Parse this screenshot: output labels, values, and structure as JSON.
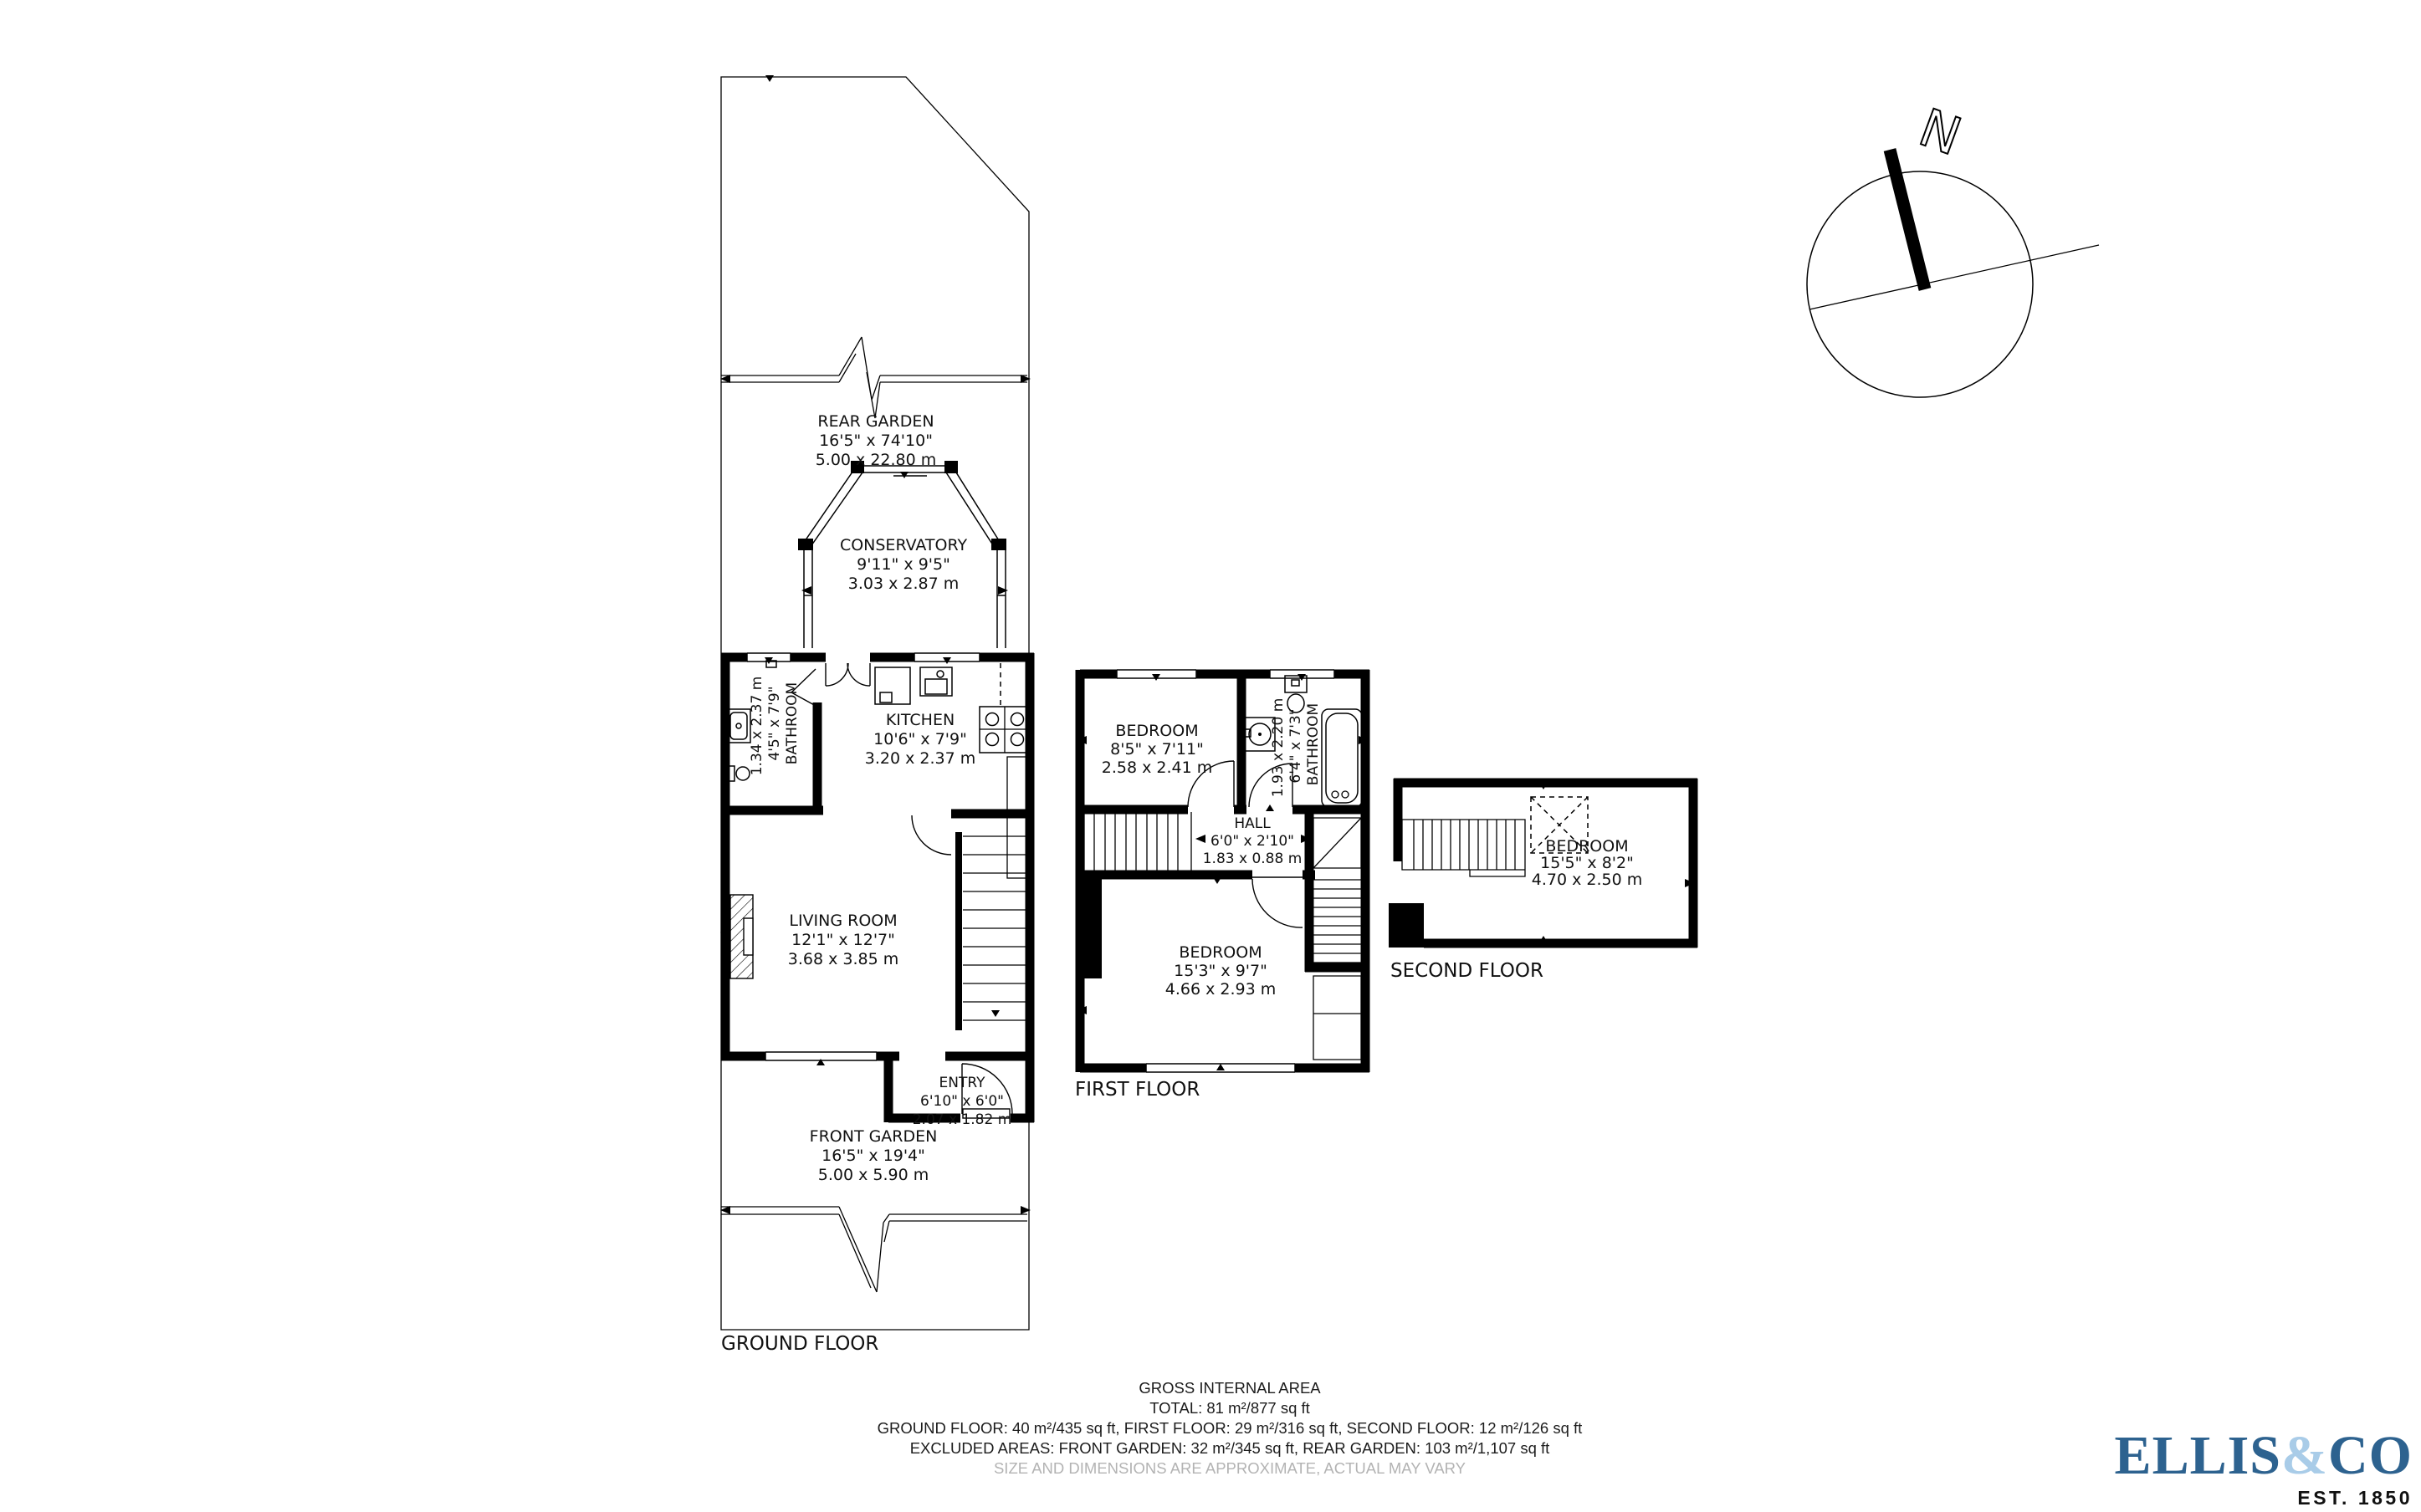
{
  "compass": {
    "north": "N"
  },
  "gf": {
    "label": "GROUND FLOOR",
    "rear_garden": {
      "name": "REAR GARDEN",
      "imp": "16'5\" x 74'10\"",
      "met": "5.00 x 22.80 m"
    },
    "conservatory": {
      "name": "CONSERVATORY",
      "imp": "9'11\" x 9'5\"",
      "met": "3.03 x 2.87 m"
    },
    "kitchen": {
      "name": "KITCHEN",
      "imp": "10'6\" x 7'9\"",
      "met": "3.20 x 2.37 m"
    },
    "bathroom": {
      "name": "BATHROOM",
      "imp": "4'5\" x 7'9\"",
      "met": "1.34 x 2.37 m"
    },
    "living": {
      "name": "LIVING ROOM",
      "imp": "12'1\" x 12'7\"",
      "met": "3.68 x 3.85 m"
    },
    "entry": {
      "name": "ENTRY",
      "imp": "6'10\" x 6'0\"",
      "met": "2.07 x 1.82 m"
    },
    "front_garden": {
      "name": "FRONT GARDEN",
      "imp": "16'5\" x 19'4\"",
      "met": "5.00 x 5.90 m"
    }
  },
  "ff": {
    "label": "FIRST FLOOR",
    "bedroom1": {
      "name": "BEDROOM",
      "imp": "8'5\" x 7'11\"",
      "met": "2.58 x 2.41 m"
    },
    "bathroom": {
      "name": "BATHROOM",
      "imp": "6'4\" x 7'3\"",
      "met": "1.93 x 2.20 m"
    },
    "hall": {
      "name": "HALL",
      "imp": "6'0\" x 2'10\"",
      "met": "1.83 x 0.88 m"
    },
    "bedroom2": {
      "name": "BEDROOM",
      "imp": "15'3\" x 9'7\"",
      "met": "4.66 x 2.93 m"
    }
  },
  "sf": {
    "label": "SECOND FLOOR",
    "bedroom": {
      "name": "BEDROOM",
      "imp": "15'5\" x 8'2\"",
      "met": "4.70 x 2.50 m"
    }
  },
  "summary": {
    "l1": "GROSS INTERNAL AREA",
    "l2": "TOTAL: 81 m²/877 sq ft",
    "l3": "GROUND FLOOR: 40 m²/435 sq ft, FIRST FLOOR: 29 m²/316 sq ft, SECOND FLOOR: 12 m²/126 sq ft",
    "l4": "EXCLUDED AREAS: FRONT GARDEN: 32 m²/345 sq ft, REAR GARDEN: 103 m²/1,107 sq ft",
    "l5": "SIZE AND DIMENSIONS ARE APPROXIMATE, ACTUAL MAY VARY"
  },
  "logo": {
    "name1": "ELLIS",
    "amp": "&",
    "name2": "CO",
    "est": "EST. 1850",
    "colors": {
      "dark": "#2d628f",
      "light": "#a9cce8"
    }
  }
}
